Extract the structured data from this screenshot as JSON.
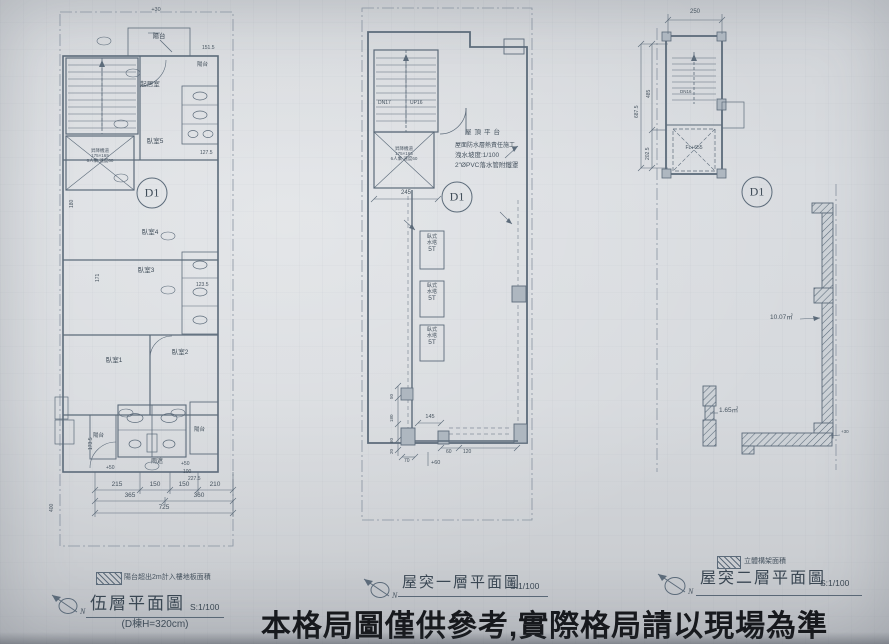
{
  "disclaimer": "本格局圖僅供參考,實際格局請以現場為準",
  "shared": {
    "north": "N",
    "unit_tag": "D1",
    "elevator": {
      "l1": "昇降機道",
      "l2": "175×165",
      "l3": "6人乘 速度60"
    }
  },
  "plan_left": {
    "title": "伍層平面圖",
    "scale": "S:1/100",
    "subtitle": "(D棟H=320cm)",
    "legend": "陽台超出2m計入樓地板面積",
    "rooms": {
      "living": "起居室",
      "bed5": "臥室5",
      "bed4": "臥室4",
      "bed3": "臥室3",
      "bed2": "臥室2",
      "bed1": "臥室1",
      "balcony": "陽台",
      "canopy": "雨遮"
    },
    "dims": {
      "top": "+30",
      "right_top": "151.5",
      "right_mid": "127.5",
      "right_low": "123.5",
      "left_a": "180",
      "left_b": "171",
      "left_c": "173.5",
      "left_total": "400",
      "plus_left": "+50",
      "plus_right": "+50",
      "w1": "215",
      "w2": "150",
      "w3": "150",
      "w4": "210",
      "s1": "365",
      "s2": "360",
      "total": "725",
      "sub_a": "100",
      "sub_b": "227.5"
    }
  },
  "plan_mid": {
    "title": "屋突一層平面圖",
    "scale": "S:1/100",
    "notes": {
      "n1": "屋頂平台",
      "n2": "屋面防水層熱責任施工",
      "n3": "洩水坡度:1/100",
      "n4": "2\"ØPVC落水管附鐵罩"
    },
    "stair": {
      "dn": "DN17",
      "up": "UP16"
    },
    "tank": {
      "l1": "臥式",
      "l2": "水塔",
      "l3": "5T"
    },
    "dims": {
      "d245": "245",
      "d145": "145",
      "d60": "60",
      "d120": "120",
      "d70": "70",
      "dplus": "+60",
      "v50": "50",
      "v180": "180",
      "v60": "60",
      "v20": "20"
    }
  },
  "plan_right": {
    "title": "屋突二層平面圖",
    "scale": "S:1/100",
    "legend": "立體構架面積",
    "stair_dn": "DN16",
    "fl": "FL+655",
    "areas": {
      "big": "10.07㎡",
      "small": "1.65㎡"
    },
    "dims": {
      "top": "250",
      "v1": "485",
      "v2": "202.5",
      "vtotal": "687.5",
      "plus": "+30"
    }
  }
}
